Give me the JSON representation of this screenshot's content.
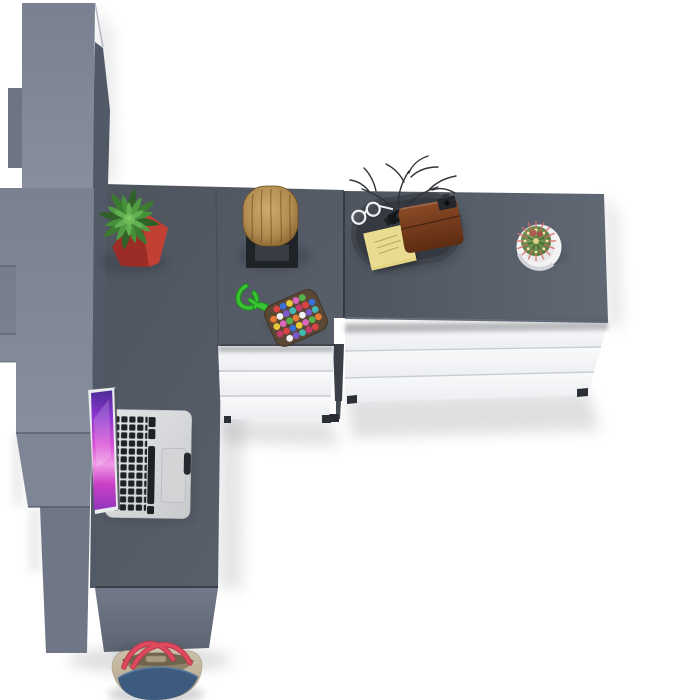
{
  "canvas": {
    "width": 675,
    "height": 700
  },
  "colors": {
    "floor": "#ffffff",
    "wardrobe": "#7d8494",
    "wardrobeEdge": "#525966",
    "desk": "#525963",
    "sideboardTop": "#545b66",
    "panel": "#6e7584",
    "drawer": "#f4f5f7",
    "seam": "#c9ccd1",
    "divider": "#3a3f48",
    "potRed": "#c13f33",
    "potRedDark": "#9c2d26",
    "leaf": "#4f9a42",
    "wood": "#b08a4e",
    "stand": "#1f2226",
    "tray": "#3b4048",
    "note": "#e9dc90",
    "wallet": "#7a3d1d",
    "cord": "#38c434",
    "beadPad": "#5a4734",
    "cactus": "#5d8247",
    "spine": "#d4706b",
    "potWhite": "#f3f3f4",
    "alu": "#d8dadc",
    "key": "#1e2126",
    "bagBeige": "#c7bba3",
    "denim": "#3d5b7e",
    "strap": "#e04a5e",
    "shadow": "#2c313a"
  },
  "objects": {
    "wardrobe": {
      "label": "tall wardrobe cabinet",
      "color": "#7d8494"
    },
    "desk": {
      "label": "corner desk surface",
      "color": "#525963"
    },
    "sideboard": {
      "label": "sideboard with drawers",
      "color": "#545b66",
      "drawer_count": 3
    },
    "desk_drawers": {
      "label": "desk drawer unit",
      "color": "#f4f5f7",
      "drawer_count": 3
    },
    "laptop": {
      "label": "open laptop with colorful wallpaper",
      "body_color": "#d8dadc"
    },
    "plant": {
      "label": "succulent in red square pot",
      "pot_color": "#c13f33"
    },
    "stool": {
      "label": "wooden log stool on black stand",
      "wood_color": "#b08a4e"
    },
    "keychain": {
      "label": "beaded keychain with green cord",
      "cord_color": "#38c434"
    },
    "tray": {
      "label": "valet tray with accessories",
      "items": [
        "eyeglasses",
        "wristwatch",
        "sticky notepad",
        "leather wallet",
        "decorative twigs",
        "black accessory"
      ]
    },
    "cactus": {
      "label": "cactus in round white pot",
      "pot_color": "#f3f3f4"
    },
    "bag": {
      "label": "canvas tote bag with denim panel",
      "strap_color": "#e04a5e"
    }
  }
}
